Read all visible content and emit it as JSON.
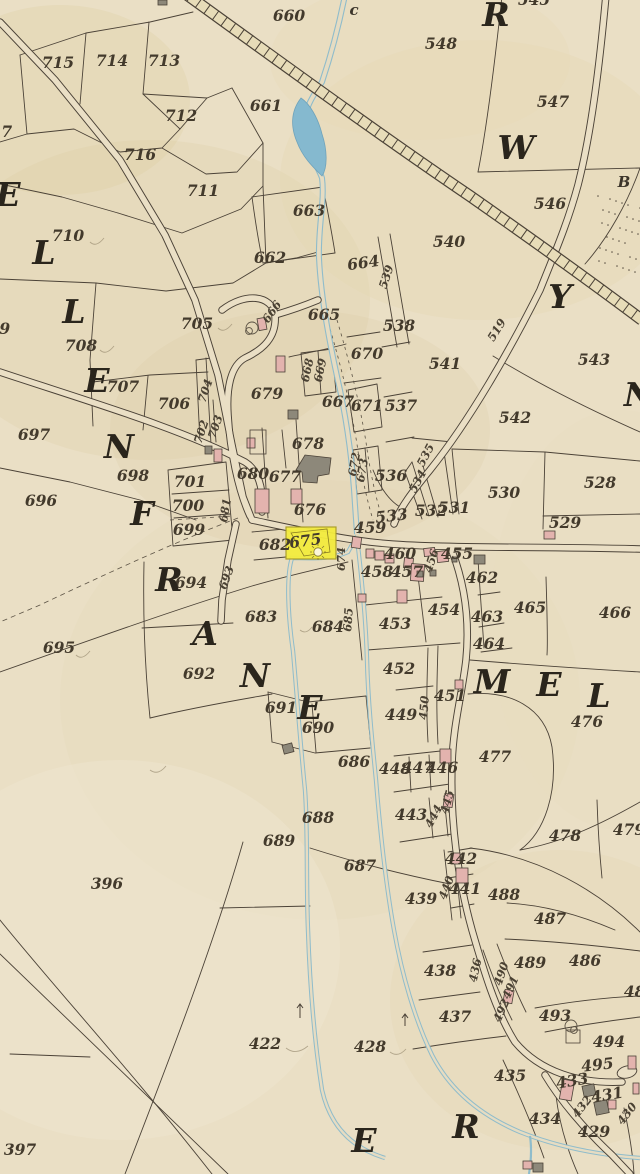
{
  "map": {
    "type": "historical-cadastral-map",
    "highlight": {
      "parcel": "675",
      "fill": "#f3ec3e",
      "border": "#a99c27"
    },
    "palette": {
      "paper": "#eadfc5",
      "ink": "#4b4237",
      "river": "#8fbccb",
      "pond": "#85b9cf",
      "rail_band": "#e7dcb8",
      "building_pink": "#e3b3ae",
      "building_grey": "#8d887a",
      "label_ink": "#433a2c"
    },
    "labels": [
      {
        "t": "715",
        "x": 58,
        "y": 68,
        "k": "n"
      },
      {
        "t": "714",
        "x": 112,
        "y": 66,
        "k": "n"
      },
      {
        "t": "713",
        "x": 164,
        "y": 66,
        "k": "n"
      },
      {
        "t": "712",
        "x": 181,
        "y": 121,
        "k": "n"
      },
      {
        "t": "716",
        "x": 140,
        "y": 160,
        "k": "n"
      },
      {
        "t": "711",
        "x": 203,
        "y": 196,
        "k": "n"
      },
      {
        "t": "710",
        "x": 68,
        "y": 241,
        "k": "n"
      },
      {
        "t": "717",
        "x": -4,
        "y": 137,
        "k": "n"
      },
      {
        "t": "709",
        "x": -6,
        "y": 334,
        "k": "n"
      },
      {
        "t": "708",
        "x": 81,
        "y": 351,
        "k": "n"
      },
      {
        "t": "705",
        "x": 197,
        "y": 329,
        "k": "n"
      },
      {
        "t": "707",
        "x": 123,
        "y": 392,
        "k": "n"
      },
      {
        "t": "706",
        "x": 174,
        "y": 409,
        "k": "n"
      },
      {
        "t": "697",
        "x": 34,
        "y": 440,
        "k": "n"
      },
      {
        "t": "698",
        "x": 133,
        "y": 481,
        "k": "n"
      },
      {
        "t": "701",
        "x": 190,
        "y": 487,
        "k": "n"
      },
      {
        "t": "700",
        "x": 188,
        "y": 511,
        "k": "n"
      },
      {
        "t": "699",
        "x": 189,
        "y": 535,
        "k": "n"
      },
      {
        "t": "696",
        "x": 41,
        "y": 506,
        "k": "n"
      },
      {
        "t": "695",
        "x": 59,
        "y": 653,
        "k": "n"
      },
      {
        "t": "694",
        "x": 191,
        "y": 588,
        "k": "n"
      },
      {
        "t": "683",
        "x": 261,
        "y": 622,
        "k": "n"
      },
      {
        "t": "692",
        "x": 199,
        "y": 679,
        "k": "n"
      },
      {
        "t": "691",
        "x": 281,
        "y": 713,
        "k": "n"
      },
      {
        "t": "690",
        "x": 318,
        "y": 733,
        "k": "n"
      },
      {
        "t": "686",
        "x": 354,
        "y": 767,
        "k": "n"
      },
      {
        "t": "689",
        "x": 279,
        "y": 846,
        "k": "n"
      },
      {
        "t": "688",
        "x": 318,
        "y": 823,
        "k": "n"
      },
      {
        "t": "687",
        "x": 360,
        "y": 871,
        "k": "n"
      },
      {
        "t": "684",
        "x": 328,
        "y": 632,
        "k": "n"
      },
      {
        "t": "679",
        "x": 267,
        "y": 399,
        "k": "n"
      },
      {
        "t": "680",
        "x": 253,
        "y": 479,
        "k": "n"
      },
      {
        "t": "677",
        "x": 285,
        "y": 482,
        "k": "n"
      },
      {
        "t": "678",
        "x": 308,
        "y": 449,
        "k": "n"
      },
      {
        "t": "676",
        "x": 310,
        "y": 515,
        "k": "n"
      },
      {
        "t": "682",
        "x": 275,
        "y": 550,
        "k": "n"
      },
      {
        "t": "675",
        "x": 306,
        "y": 546,
        "k": "n",
        "r": -8
      },
      {
        "t": "660",
        "x": 289,
        "y": 21,
        "k": "n"
      },
      {
        "t": "661",
        "x": 266,
        "y": 111,
        "k": "n"
      },
      {
        "t": "663",
        "x": 309,
        "y": 216,
        "k": "n"
      },
      {
        "t": "662",
        "x": 270,
        "y": 263,
        "k": "n"
      },
      {
        "t": "664",
        "x": 364,
        "y": 268,
        "k": "n",
        "r": -8
      },
      {
        "t": "665",
        "x": 324,
        "y": 320,
        "k": "n"
      },
      {
        "t": "670",
        "x": 367,
        "y": 359,
        "k": "n"
      },
      {
        "t": "671",
        "x": 367,
        "y": 411,
        "k": "n"
      },
      {
        "t": "667",
        "x": 338,
        "y": 407,
        "k": "n"
      },
      {
        "t": "548",
        "x": 441,
        "y": 49,
        "k": "n"
      },
      {
        "t": "547",
        "x": 553,
        "y": 107,
        "k": "n"
      },
      {
        "t": "546",
        "x": 550,
        "y": 209,
        "k": "n"
      },
      {
        "t": "545",
        "x": 534,
        "y": 5,
        "k": "n"
      },
      {
        "t": "540",
        "x": 449,
        "y": 247,
        "k": "n"
      },
      {
        "t": "541",
        "x": 445,
        "y": 369,
        "k": "n"
      },
      {
        "t": "542",
        "x": 515,
        "y": 423,
        "k": "n"
      },
      {
        "t": "543",
        "x": 594,
        "y": 365,
        "k": "n"
      },
      {
        "t": "538",
        "x": 399,
        "y": 331,
        "k": "n"
      },
      {
        "t": "537",
        "x": 401,
        "y": 411,
        "k": "n"
      },
      {
        "t": "536",
        "x": 391,
        "y": 481,
        "k": "n"
      },
      {
        "t": "533",
        "x": 392,
        "y": 521,
        "k": "n",
        "r": -6
      },
      {
        "t": "532",
        "x": 431,
        "y": 516,
        "k": "n"
      },
      {
        "t": "531",
        "x": 454,
        "y": 513,
        "k": "n"
      },
      {
        "t": "530",
        "x": 504,
        "y": 498,
        "k": "n"
      },
      {
        "t": "529",
        "x": 565,
        "y": 528,
        "k": "n"
      },
      {
        "t": "528",
        "x": 600,
        "y": 488,
        "k": "n"
      },
      {
        "t": "459",
        "x": 370,
        "y": 533,
        "k": "n"
      },
      {
        "t": "458",
        "x": 377,
        "y": 577,
        "k": "n"
      },
      {
        "t": "457",
        "x": 407,
        "y": 577,
        "k": "n"
      },
      {
        "t": "460",
        "x": 400,
        "y": 559,
        "k": "n"
      },
      {
        "t": "455",
        "x": 457,
        "y": 559,
        "k": "n"
      },
      {
        "t": "462",
        "x": 482,
        "y": 583,
        "k": "n"
      },
      {
        "t": "465",
        "x": 530,
        "y": 613,
        "k": "n"
      },
      {
        "t": "466",
        "x": 615,
        "y": 618,
        "k": "n"
      },
      {
        "t": "463",
        "x": 487,
        "y": 622,
        "k": "n"
      },
      {
        "t": "464",
        "x": 489,
        "y": 649,
        "k": "n"
      },
      {
        "t": "453",
        "x": 395,
        "y": 629,
        "k": "n"
      },
      {
        "t": "454",
        "x": 444,
        "y": 615,
        "k": "n"
      },
      {
        "t": "452",
        "x": 399,
        "y": 674,
        "k": "n"
      },
      {
        "t": "451",
        "x": 450,
        "y": 701,
        "k": "n"
      },
      {
        "t": "449",
        "x": 401,
        "y": 720,
        "k": "n"
      },
      {
        "t": "448",
        "x": 395,
        "y": 774,
        "k": "n"
      },
      {
        "t": "447",
        "x": 418,
        "y": 773,
        "k": "n"
      },
      {
        "t": "446",
        "x": 442,
        "y": 773,
        "k": "n"
      },
      {
        "t": "443",
        "x": 411,
        "y": 820,
        "k": "n"
      },
      {
        "t": "442",
        "x": 461,
        "y": 864,
        "k": "n"
      },
      {
        "t": "441",
        "x": 465,
        "y": 894,
        "k": "n"
      },
      {
        "t": "439",
        "x": 421,
        "y": 904,
        "k": "n"
      },
      {
        "t": "438",
        "x": 440,
        "y": 976,
        "k": "n"
      },
      {
        "t": "437",
        "x": 455,
        "y": 1022,
        "k": "n"
      },
      {
        "t": "488",
        "x": 504,
        "y": 900,
        "k": "n"
      },
      {
        "t": "487",
        "x": 550,
        "y": 924,
        "k": "n"
      },
      {
        "t": "489",
        "x": 530,
        "y": 968,
        "k": "n"
      },
      {
        "t": "486",
        "x": 585,
        "y": 966,
        "k": "n"
      },
      {
        "t": "486",
        "x": 640,
        "y": 997,
        "k": "n"
      },
      {
        "t": "493",
        "x": 555,
        "y": 1021,
        "k": "n"
      },
      {
        "t": "494",
        "x": 609,
        "y": 1047,
        "k": "n"
      },
      {
        "t": "495",
        "x": 598,
        "y": 1070,
        "k": "n",
        "r": -6
      },
      {
        "t": "435",
        "x": 510,
        "y": 1081,
        "k": "n"
      },
      {
        "t": "433",
        "x": 573,
        "y": 1086,
        "k": "n",
        "r": -10
      },
      {
        "t": "431",
        "x": 608,
        "y": 1100,
        "k": "n",
        "r": -10
      },
      {
        "t": "434",
        "x": 545,
        "y": 1124,
        "k": "n"
      },
      {
        "t": "429",
        "x": 594,
        "y": 1137,
        "k": "n"
      },
      {
        "t": "428",
        "x": 370,
        "y": 1052,
        "k": "n"
      },
      {
        "t": "422",
        "x": 265,
        "y": 1049,
        "k": "n"
      },
      {
        "t": "396",
        "x": 107,
        "y": 889,
        "k": "n"
      },
      {
        "t": "397",
        "x": 20,
        "y": 1155,
        "k": "n"
      },
      {
        "t": "476",
        "x": 587,
        "y": 727,
        "k": "n"
      },
      {
        "t": "477",
        "x": 495,
        "y": 762,
        "k": "n"
      },
      {
        "t": "478",
        "x": 565,
        "y": 841,
        "k": "n"
      },
      {
        "t": "479",
        "x": 629,
        "y": 835,
        "k": "n"
      },
      {
        "t": "704",
        "x": 209,
        "y": 392,
        "k": "s",
        "r": -72
      },
      {
        "t": "703",
        "x": 219,
        "y": 428,
        "k": "s",
        "r": -72
      },
      {
        "t": "702",
        "x": 205,
        "y": 433,
        "k": "s",
        "r": -72
      },
      {
        "t": "666",
        "x": 275,
        "y": 314,
        "k": "s",
        "r": -55
      },
      {
        "t": "668",
        "x": 311,
        "y": 371,
        "k": "s",
        "r": -78
      },
      {
        "t": "669",
        "x": 324,
        "y": 371,
        "k": "s",
        "r": -78
      },
      {
        "t": "681",
        "x": 229,
        "y": 511,
        "k": "s",
        "r": -80
      },
      {
        "t": "693",
        "x": 230,
        "y": 579,
        "k": "s",
        "r": -70
      },
      {
        "t": "674",
        "x": 345,
        "y": 559,
        "k": "s",
        "r": -90
      },
      {
        "t": "685",
        "x": 352,
        "y": 620,
        "k": "s",
        "r": -86
      },
      {
        "t": "672",
        "x": 358,
        "y": 465,
        "k": "s",
        "r": -80
      },
      {
        "t": "673",
        "x": 366,
        "y": 471,
        "k": "s",
        "r": -80
      },
      {
        "t": "539",
        "x": 390,
        "y": 278,
        "k": "s",
        "r": -72
      },
      {
        "t": "519",
        "x": 500,
        "y": 332,
        "k": "s",
        "r": -58
      },
      {
        "t": "535",
        "x": 429,
        "y": 457,
        "k": "s",
        "r": -62
      },
      {
        "t": "534",
        "x": 421,
        "y": 483,
        "k": "s",
        "r": -62
      },
      {
        "t": "456",
        "x": 435,
        "y": 562,
        "k": "s",
        "r": -72
      },
      {
        "t": "450",
        "x": 428,
        "y": 708,
        "k": "s",
        "r": -86
      },
      {
        "t": "445",
        "x": 451,
        "y": 803,
        "k": "s",
        "r": -75
      },
      {
        "t": "444",
        "x": 437,
        "y": 818,
        "k": "s",
        "r": -62
      },
      {
        "t": "440",
        "x": 450,
        "y": 889,
        "k": "s",
        "r": -70
      },
      {
        "t": "436",
        "x": 479,
        "y": 971,
        "k": "s",
        "r": -78
      },
      {
        "t": "490",
        "x": 505,
        "y": 975,
        "k": "s",
        "r": -72
      },
      {
        "t": "491",
        "x": 514,
        "y": 989,
        "k": "s",
        "r": -66
      },
      {
        "t": "492",
        "x": 505,
        "y": 1012,
        "k": "s",
        "r": -66
      },
      {
        "t": "432",
        "x": 585,
        "y": 1109,
        "k": "s",
        "r": -52
      },
      {
        "t": "430",
        "x": 630,
        "y": 1116,
        "k": "s",
        "r": -52
      },
      {
        "t": "E",
        "x": 8,
        "y": 206,
        "k": "L"
      },
      {
        "t": "L",
        "x": 44,
        "y": 264,
        "k": "L"
      },
      {
        "t": "L",
        "x": 74,
        "y": 323,
        "k": "L"
      },
      {
        "t": "E",
        "x": 97,
        "y": 392,
        "k": "L"
      },
      {
        "t": "N",
        "x": 119,
        "y": 458,
        "k": "L"
      },
      {
        "t": "F",
        "x": 142,
        "y": 525,
        "k": "L"
      },
      {
        "t": "R",
        "x": 169,
        "y": 591,
        "k": "L"
      },
      {
        "t": "A",
        "x": 205,
        "y": 645,
        "k": "L"
      },
      {
        "t": "N",
        "x": 255,
        "y": 687,
        "k": "L"
      },
      {
        "t": "E",
        "x": 310,
        "y": 719,
        "k": "L"
      },
      {
        "t": "R",
        "x": 496,
        "y": 26,
        "k": "L"
      },
      {
        "t": "W",
        "x": 516,
        "y": 159,
        "k": "L"
      },
      {
        "t": "Y",
        "x": 560,
        "y": 308,
        "k": "L"
      },
      {
        "t": "N",
        "x": 639,
        "y": 406,
        "k": "L"
      },
      {
        "t": "M",
        "x": 492,
        "y": 693,
        "k": "L"
      },
      {
        "t": "E",
        "x": 549,
        "y": 696,
        "k": "L"
      },
      {
        "t": "L",
        "x": 599,
        "y": 707,
        "k": "L"
      },
      {
        "t": "E",
        "x": 364,
        "y": 1152,
        "k": "L"
      },
      {
        "t": "R",
        "x": 466,
        "y": 1138,
        "k": "L"
      },
      {
        "t": "c",
        "x": 354,
        "y": 15,
        "k": "m"
      },
      {
        "t": "B",
        "x": 624,
        "y": 187,
        "k": "m"
      }
    ]
  }
}
